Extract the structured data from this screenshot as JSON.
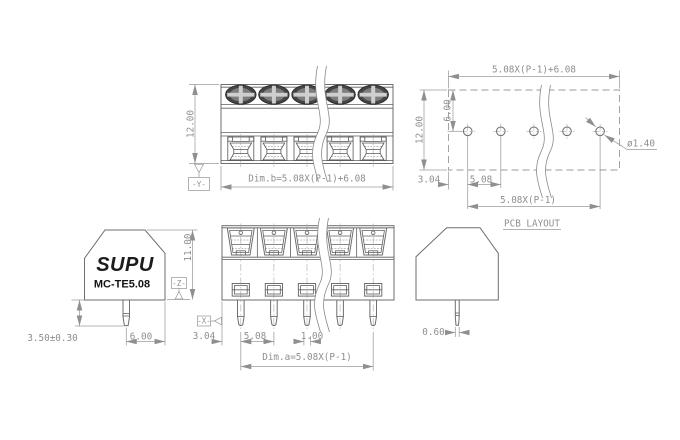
{
  "drawing": {
    "positions_shown": 5,
    "top_view": {
      "height": "12.00",
      "width_formula": "Dim.b=5.08X(P-1)+6.08",
      "datum": "-Y-"
    },
    "pcb_layout": {
      "title": "PCB LAYOUT",
      "overall_width": "5.08X(P-1)+6.08",
      "board_height": "12.00",
      "hole_row_offset": "6.00",
      "edge_to_first_hole": "3.04",
      "hole_pitch": "5.08",
      "hole_span": "5.08X(P-1)",
      "hole_diameter": "ø1.40"
    },
    "side_view": {
      "brand": "SUPU",
      "model": "MC-TE5.08",
      "body_height": "11.00",
      "pin_length": "3.50±0.30",
      "pin_to_back": "6.00",
      "datum": "-Z-"
    },
    "front_view": {
      "edge_to_first_pin": "3.04",
      "pin_pitch": "5.08",
      "pin_width": "1.00",
      "span_formula": "Dim.a=5.08X(P-1)",
      "datum": "-X-"
    },
    "side_profile": {
      "pin_thickness": "0.60"
    }
  }
}
